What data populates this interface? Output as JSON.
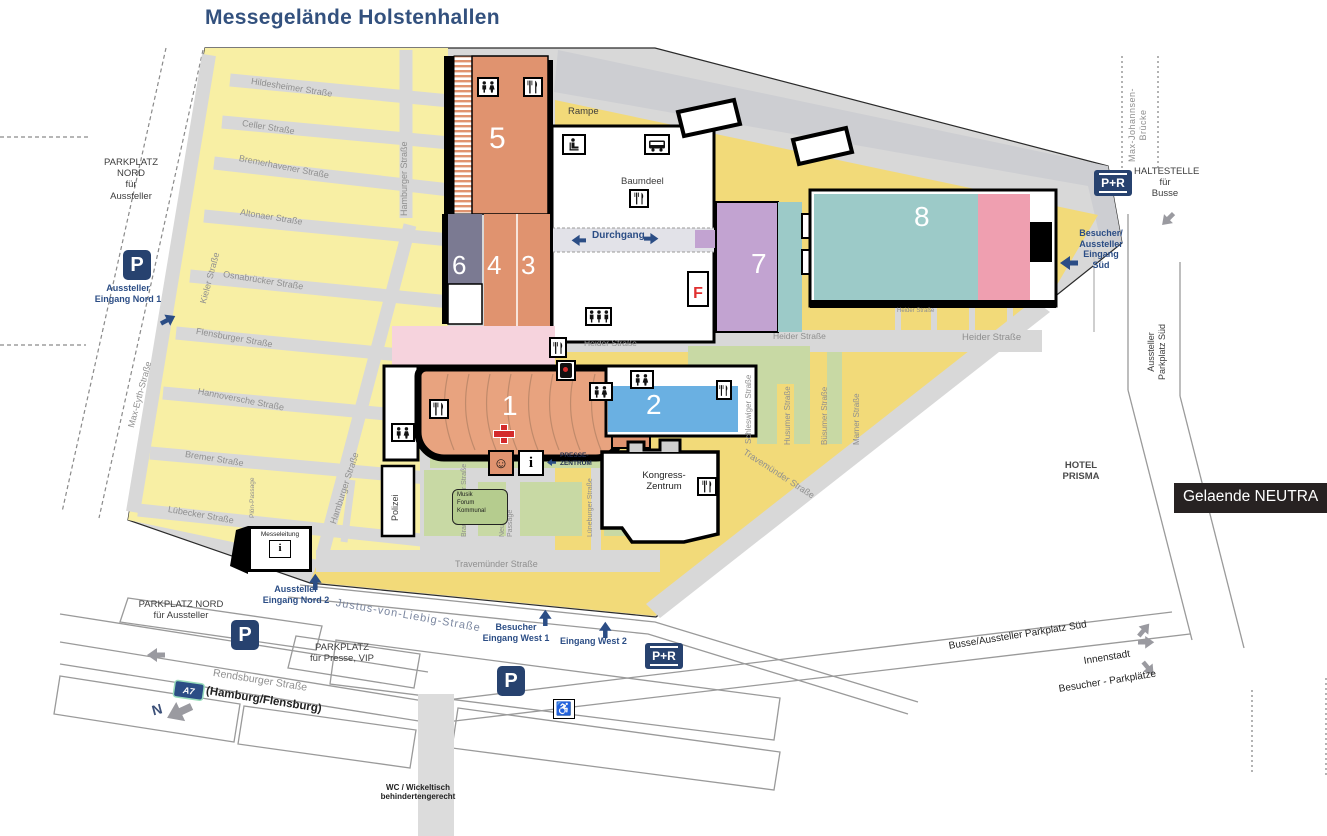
{
  "title": "Messegelände Holstenhallen",
  "overlay_label": "Gelaende NEUTRA",
  "halls": {
    "h1": "1",
    "h2": "2",
    "h3": "3",
    "h4": "4",
    "h5": "5",
    "h6": "6",
    "h7": "7",
    "h8": "8"
  },
  "streets": {
    "hildesheimer": "Hildesheimer Straße",
    "celler": "Celler Straße",
    "bremerhavener": "Bremerhavener Straße",
    "altonaer": "Altonaer Straße",
    "osnabruecker": "Osnabrücker Straße",
    "flensburger": "Flensburger Straße",
    "hannoversche": "Hannoversche Straße",
    "bremer": "Bremer Straße",
    "luebecker": "Lübecker Straße",
    "hamburger": "Hamburger Straße",
    "kieler": "Kieler Straße",
    "max_eyth": "Max-Eyth-Straße",
    "ploen_passage": "Plön-Passage",
    "heider": "Heider Straße",
    "schleswiger": "Schleswiger Straße",
    "husumer": "Husumer Straße",
    "buesumer": "Büsumer Straße",
    "marner": "Marner Straße",
    "travemuender": "Travemünder Straße",
    "braunschweiger": "Braunschweiger Straße",
    "neumuenster_passage": "Neumünster\nPassage",
    "lueneburger": "Lüneburger Straße",
    "justus": "Justus-von-Liebig-Straße",
    "rendsburger": "Rendsburger Straße",
    "max_johannsen": "Max-Johannsen-\nBrücke"
  },
  "buildings": {
    "rampe": "Rampe",
    "baumdeel": "Baumdeel",
    "durchgang": "Durchgang",
    "kongress": "Kongress-\nZentrum",
    "presse": "PRESSE-\nZENTRUM",
    "polizei": "Polizei",
    "messeleitung": "Messeleitung",
    "musik_forum": "Musik\nForum\nKommunal",
    "hotel": "HOTEL\nPRISMA",
    "wc_note": "WC / Wickeltisch\nbehindertengerecht"
  },
  "parking": {
    "p": "P",
    "nord_top": "PARKPLATZ\nNORD\nfür\nAussteller",
    "nord_bottom": "PARKPLATZ NORD\nfür Aussteller",
    "presse_vip": "PARKPLATZ\nfür Presse, VIP",
    "aussteller_sued": "Aussteller\nParkplatz Süd",
    "busse_sued": "Busse/Aussteller Parkplatz Süd",
    "besucher": "Besucher - Parkplätze"
  },
  "entrances": {
    "nord1": "Aussteller\nEingang Nord 1",
    "nord2": "Aussteller\nEingang Nord 2",
    "west1": "Besucher\nEingang West 1",
    "west2": "Eingang West 2",
    "sued": "Besucher/\nAussteller\nEingang\nSüd"
  },
  "transit": {
    "haltestelle": "HALTESTELLE\nfür\nBusse",
    "p_plus_r": "P+R",
    "innenstadt": "Innenstadt",
    "a7": "A7",
    "a7_dest": "(Hamburg/Flensburg)",
    "north": "N",
    "hotel_nearby": "HOTEL\nPRISMA"
  },
  "glyphs": {
    "f": "F",
    "info": "i",
    "smiley": "☺",
    "wheelchair": "♿"
  },
  "icons": {
    "wc": "two-person-wc-pictogram",
    "restaurant": "fork-and-knife-pictogram",
    "bus": "bus-pictogram",
    "cloakroom": "seat-pictogram",
    "group": "three-person-pictogram",
    "first_aid": "red-cross",
    "fire_extinguisher": "extinguisher-pictogram",
    "info": "info-i",
    "smiley": "smiley-face",
    "wheelchair": "wheelchair-symbol",
    "arrow": "direction-arrow"
  },
  "colors": {
    "accent_blue": "#2b4d85",
    "sign_navy": "#27426f",
    "hall_orange": "#e0936f",
    "hall_slate": "#7b7a92",
    "hall_lavender": "#c2a3d1",
    "hall_teal": "#9ccac8",
    "hall_blue": "#6ab0e2",
    "pink": "#ef9fb0",
    "pale_pink": "#f6d3dd",
    "green": "#c8d9a4",
    "pale_yellow": "#f8efa4",
    "golden": "#f2da79",
    "street_gray": "#d8d8d8"
  }
}
